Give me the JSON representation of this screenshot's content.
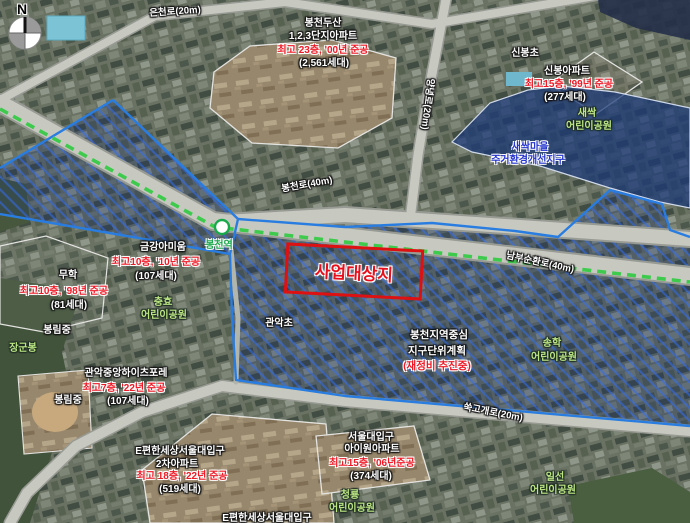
{
  "compass": {
    "north": "N"
  },
  "roads": {
    "euncheon": "은천로(20m)",
    "yangnyeong": "양녕로(20m)",
    "bongcheon": "봉천로(40m)",
    "nambu_sunhwan": "남부순환로(40m)",
    "ssukgogae": "쑥고개로(20m)"
  },
  "station": {
    "bongcheon": "봉천역"
  },
  "site": {
    "label": "사업대상지"
  },
  "zones": {
    "district_plan": {
      "line1": "봉천지역중심",
      "line2": "지구단위계획",
      "line3": "(재정비 추진중)"
    },
    "saessak_renewal": {
      "line1": "새싹마을",
      "line2": "주거환경개선지구"
    }
  },
  "apartments": {
    "dusan": {
      "name1": "봉천두산",
      "name2": "1,2,3단지아파트",
      "spec": "최고 23층, '00년 준공",
      "units": "(2,561세대)"
    },
    "sinbong": {
      "name1": "신봉아파트",
      "spec": "최고15층, '99년 준공",
      "units": "(277세대)"
    },
    "kumkang": {
      "name1": "금강아미움",
      "spec": "최고10층, '10년 준공",
      "units": "(107세대)"
    },
    "muhak": {
      "name1": "무학",
      "spec": "최고10층, '98년 준공",
      "units": "(81세대)"
    },
    "heightsforet": {
      "name1": "관악중앙하이츠포레",
      "spec": "최고7층, '22년 준공",
      "units": "(107세대)"
    },
    "epyeonhan2": {
      "name1": "E편한세상서울대입구",
      "name2": "2차아파트",
      "spec": "최고 18층, '22년 준공",
      "units": "(519세대)"
    },
    "iwon": {
      "name1": "서울대입구",
      "name2": "아이원아파트",
      "spec": "최고15층, '06년준공",
      "units": "(374세대)"
    },
    "epyeonhan_partial": {
      "name1": "E편한세상서울대입구"
    }
  },
  "schools": {
    "sinbong_elementary": "신봉초",
    "gwanak_elementary": "관악초",
    "bongrim_middle": "봉림중"
  },
  "parks": {
    "saessak": {
      "name": "새싹",
      "suffix": "어린이공원"
    },
    "chunghyo": {
      "name": "충효",
      "suffix": "어린이공원"
    },
    "songhak": {
      "name": "송학",
      "suffix": "어린이공원"
    },
    "ilseon": {
      "name": "일선",
      "suffix": "어린이공원"
    },
    "cheongnyong": {
      "name": "청룡",
      "suffix": "어린이공원"
    }
  },
  "landmarks": {
    "janggunbong": "장군봉"
  },
  "colors": {
    "site_outline": "#dd1111",
    "site_text": "#e80f1c",
    "district_boundary": "#2a7de0",
    "district_hatch": "#3268e8",
    "subway_line": "#3ecb4d",
    "renewal_zone_fill": "#1d3a6e",
    "renewal_zone_text": "#2333cf",
    "park_text": "#bce683",
    "spec_text": "#f01825",
    "label_text": "#ffffff",
    "road_fill": "#c7c9c1"
  }
}
